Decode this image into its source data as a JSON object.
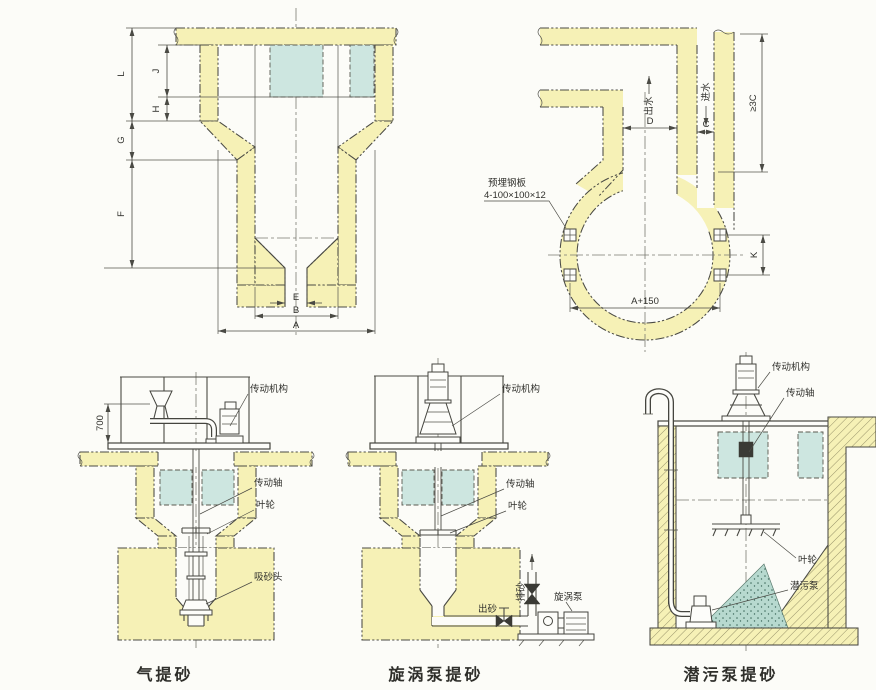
{
  "page": {
    "background": "#fcfcf8"
  },
  "colors": {
    "wall": "#f6f1b6",
    "window": "#cde6e0",
    "sand": "#b7d9cf",
    "line": "#4a4a44",
    "text": "#30302c"
  },
  "section_view": {
    "dim_labels": {
      "L": "L",
      "J": "J",
      "H": "H",
      "G": "G",
      "F": "F",
      "E": "E",
      "B": "B",
      "A": "A"
    }
  },
  "plan_view": {
    "dim_labels": {
      "D": "D",
      "C": "C",
      "K": "K",
      "A150": "A+150",
      "C3": "≥3C"
    },
    "flow_out": "出水",
    "flow_in": "进水",
    "plate_note_line1": "预埋钢板",
    "plate_note_line2": "4-100×100×12"
  },
  "airlift": {
    "caption": "气提砂",
    "height_dim": "700",
    "labels": {
      "drive": "传动机构",
      "shaft": "传动轴",
      "impeller": "叶轮",
      "suction_head": "吸砂头"
    }
  },
  "vortex": {
    "caption": "旋涡泵提砂",
    "labels": {
      "drive": "传动机构",
      "shaft": "传动轴",
      "impeller": "叶轮",
      "sand_out": "出砂",
      "sand_riser": "排砂",
      "pump": "旋涡泵"
    }
  },
  "submersible": {
    "caption": "潜污泵提砂",
    "labels": {
      "drive": "传动机构",
      "shaft": "传动轴",
      "impeller": "叶轮",
      "pump": "潜污泵"
    }
  }
}
